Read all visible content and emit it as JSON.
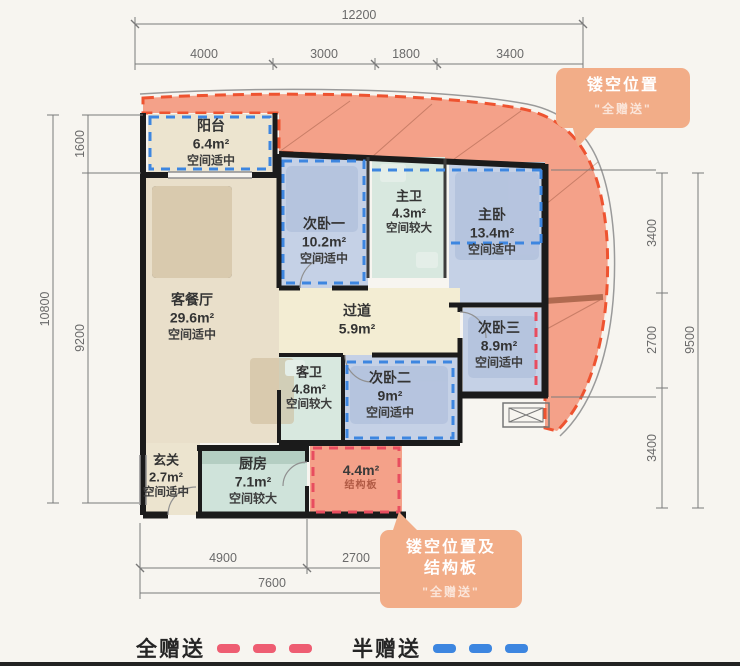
{
  "plan": {
    "dimensions": {
      "top_total": "12200",
      "top_segments": [
        "4000",
        "3000",
        "1800",
        "3400"
      ],
      "left_total": "10800",
      "left_segments": [
        "1600",
        "9200"
      ],
      "right_total": "9500",
      "right_segments": [
        "3400",
        "2700",
        "3400"
      ],
      "bottom_segments": [
        "4900",
        "2700"
      ],
      "bottom_total": "7600"
    },
    "rooms": {
      "balcony": {
        "name": "阳台",
        "area": "6.4m²",
        "note": "空间适中"
      },
      "bedroom1": {
        "name": "次卧一",
        "area": "10.2m²",
        "note": "空间适中"
      },
      "master_bath": {
        "name": "主卫",
        "area": "4.3m²",
        "note": "空间较大"
      },
      "master_bedroom": {
        "name": "主卧",
        "area": "13.4m²",
        "note": "空间适中"
      },
      "living_dining": {
        "name": "客餐厅",
        "area": "29.6m²",
        "note": "空间适中"
      },
      "hallway": {
        "name": "过道",
        "area": "5.9m²"
      },
      "bedroom3": {
        "name": "次卧三",
        "area": "8.9m²",
        "note": "空间适中"
      },
      "guest_bath": {
        "name": "客卫",
        "area": "4.8m²",
        "note": "空间较大"
      },
      "bedroom2": {
        "name": "次卧二",
        "area": "9m²",
        "note": "空间适中"
      },
      "foyer": {
        "name": "玄关",
        "area": "2.7m²",
        "note": "空间适中"
      },
      "kitchen": {
        "name": "厨房",
        "area": "7.1m²",
        "note": "空间较大"
      },
      "structural_slab": {
        "area": "4.4m²",
        "note": "结构板"
      }
    },
    "callouts": {
      "hollow_top": {
        "line1": "镂空位置",
        "line2": "\"全赠送\""
      },
      "hollow_bottom": {
        "line1": "镂空位置及",
        "line2": "结构板",
        "line3": "\"全赠送\""
      }
    },
    "legend": {
      "full_gift": {
        "label": "全赠送",
        "color": "#ee5d72"
      },
      "half_gift": {
        "label": "半赠送",
        "color": "#3d86e0"
      }
    },
    "colors": {
      "hollow_area_fill": "#f4a189",
      "hollow_area_border": "#ee5330",
      "half_gift_dash": "#3d86e0",
      "full_gift_dash": "#e84d5f",
      "bedroom_fill": "#c5d1e6",
      "bath_fill": "#d8e8df",
      "living_fill": "#e9dfca",
      "balcony_fill": "#ece4cf",
      "hallway_fill": "#f3edd3",
      "kitchen_fill": "#cfe3da",
      "wall": "#1b1b1b",
      "callout_bg": "#f2ad88"
    }
  }
}
